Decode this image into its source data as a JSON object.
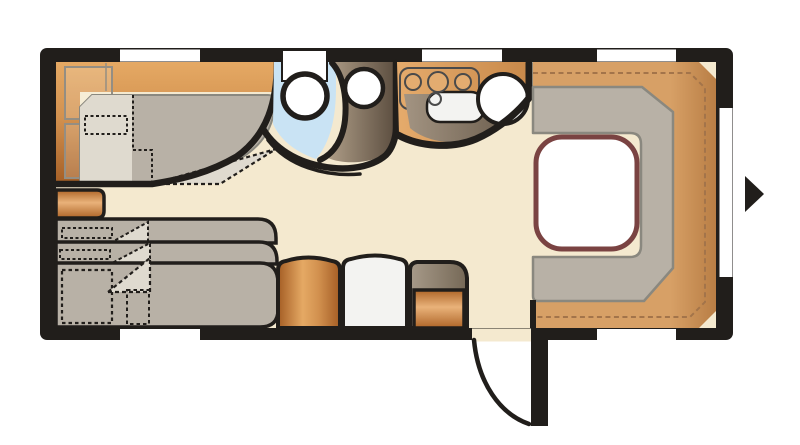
{
  "figure": {
    "type": "caravan-floor-plan",
    "orientation": "side-view-top-down",
    "entry_arrow_direction": "right"
  },
  "features": {
    "fixed_bed": "double bed with pillow and folded duvet",
    "bunk_beds": "three stacked bunks with pillows",
    "washroom": "shower tray, washbasin, toilet",
    "kitchen": "three-burner cooktop, drainer, round sink",
    "dinette": "U-shaped lounge seating with table on raised platform",
    "cabinets": "wardrobe, fridge, corner cabinet",
    "door": "entry door with outward swing arc",
    "window_count_top": 3,
    "window_count_bottom": 2,
    "window_count_right": 1
  },
  "palette": {
    "wall": "#211E1B",
    "floor": "#F4E9CF",
    "white": "#FFFFFF",
    "outlineGray": "#8A887F",
    "cushion": "#B8B1A6",
    "cushionLight": "#DFDACF",
    "blue": "#C9E3F4",
    "tableBorder": "#7A4342",
    "dashWood": "#A3744A",
    "lockerLine": "#948E83",
    "woodLight": "#E5A964",
    "wood": "#D2914F",
    "woodDark": "#A45D24",
    "stepLight": "#E9B27A",
    "stepDark": "#AE6527",
    "platformLight": "#D7A066",
    "platformDark": "#B97E45",
    "brownLight": "#AE9D87",
    "brownDark": "#5A4C3E",
    "shadowLight": "#A39482",
    "shadowDark": "#6B5D4D",
    "counterLight": "#E5AB6C",
    "counterDark": "#C8894A",
    "cabinetTopLight": "#A79A89",
    "cabinetTopDark": "#756856",
    "fridge": "#F3F3F1",
    "sinkEdge": "#D8D8D6",
    "burner": "#E3AC70",
    "cooktopStroke": "#4A4A4A"
  }
}
